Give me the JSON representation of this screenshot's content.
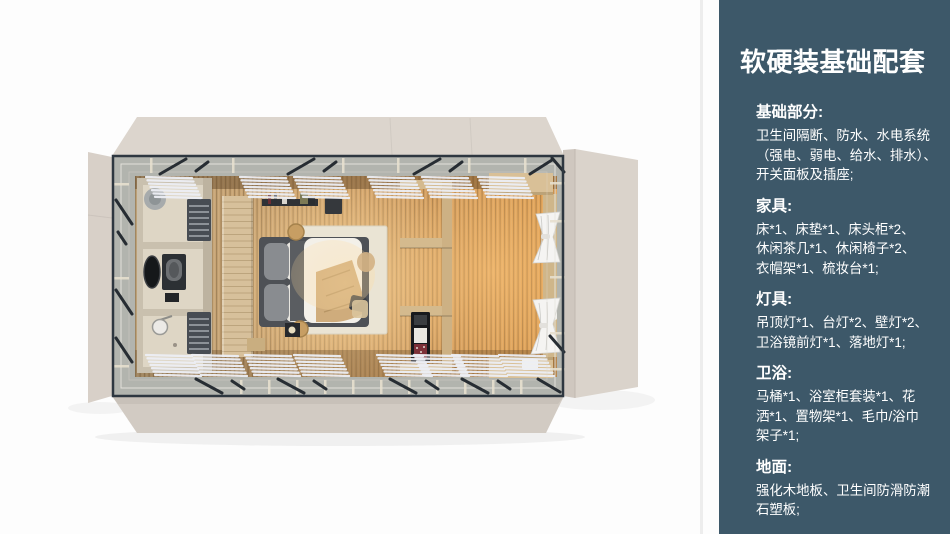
{
  "theme": {
    "sidebar_bg": "#3d5869",
    "sidebar_text": "#ffffff",
    "canvas_bg": "#fdfdfd",
    "exterior_beige": "#d8d0c8",
    "frame_dark": "#2e3740",
    "walkway_gray": "#b2b4ae",
    "wood_panel": "#d7c09b",
    "duvet_white": "#f3f0e9",
    "curtain_white": "#f5f4f2",
    "floor_wood_light": "#c3a87e",
    "floor_wood_warm": "#e2a255",
    "floor_glow": "#ffdb9e"
  },
  "sidebar": {
    "title": "软硬装基础配套",
    "sections": [
      {
        "heading": "基础部分:",
        "body": "卫生间隔断、防水、水电系统\n（强电、弱电、给水、排水）、\n开关面板及插座;"
      },
      {
        "heading": "家具:",
        "body": "床*1、床垫*1、床头柜*2、\n休闲茶几*1、休闲椅子*2、\n衣帽架*1、梳妆台*1;"
      },
      {
        "heading": "灯具:",
        "body": "吊顶灯*1、台灯*2、壁灯*2、\n卫浴镜前灯*1、落地灯*1;"
      },
      {
        "heading": "卫浴:",
        "body": "马桶*1、浴室柜套装*1、花\n洒*1、置物架*1、毛巾/浴巾\n架子*1;"
      },
      {
        "heading": "地面:",
        "body": "强化木地板、卫生间防滑防潮\n石塑板;"
      }
    ]
  }
}
